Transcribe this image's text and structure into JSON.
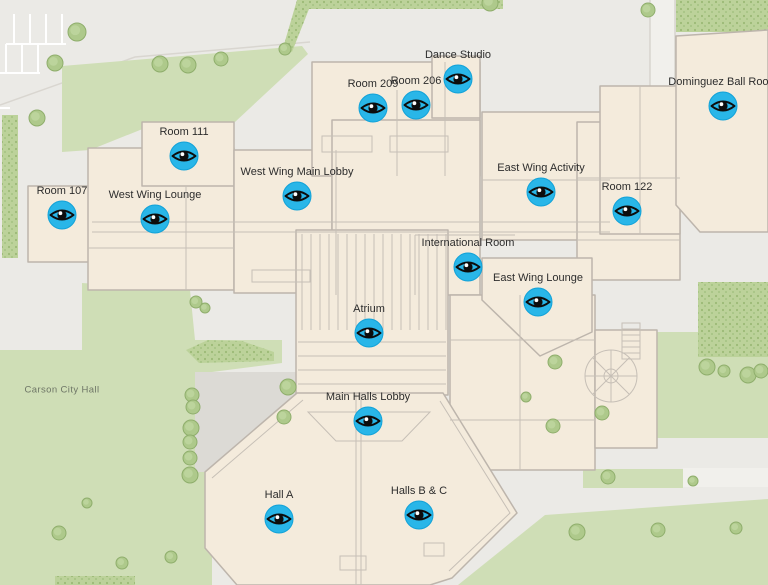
{
  "map": {
    "name": "facility-floor-plan",
    "background_color": "#ebeae6",
    "building_color": "#f4ebdc",
    "building_outline_color": "#bdb5ac",
    "lawn_color": "#cfdeb6",
    "hedge_color": "#bcd29a",
    "tree_color": "#aec98b",
    "marker_color": "#29b6e8",
    "marker_icon": "eye-icon",
    "label_color": "#2d2d2d"
  },
  "ground_label": {
    "text": "Carson City Hall"
  },
  "markers": [
    {
      "label": "Room 107",
      "x": 62,
      "y": 215
    },
    {
      "label": "West Wing Lounge",
      "x": 155,
      "y": 219
    },
    {
      "label": "Room 111",
      "x": 184,
      "y": 156
    },
    {
      "label": "West Wing Main Lobby",
      "x": 297,
      "y": 196
    },
    {
      "label": "Room 209",
      "x": 373,
      "y": 108
    },
    {
      "label": "Room 206",
      "x": 416,
      "y": 105
    },
    {
      "label": "Dance Studio",
      "x": 458,
      "y": 79
    },
    {
      "label": "East Wing Activity",
      "x": 541,
      "y": 192
    },
    {
      "label": "Room 122",
      "x": 627,
      "y": 211
    },
    {
      "label": "International Room",
      "x": 468,
      "y": 267
    },
    {
      "label": "East Wing Lounge",
      "x": 538,
      "y": 302
    },
    {
      "label": "Atrium",
      "x": 369,
      "y": 333
    },
    {
      "label": "Main Halls Lobby",
      "x": 368,
      "y": 421
    },
    {
      "label": "Hall A",
      "x": 279,
      "y": 519
    },
    {
      "label": "Halls B & C",
      "x": 419,
      "y": 515
    },
    {
      "label": "Dominguez Ball Room",
      "x": 723,
      "y": 106
    }
  ]
}
